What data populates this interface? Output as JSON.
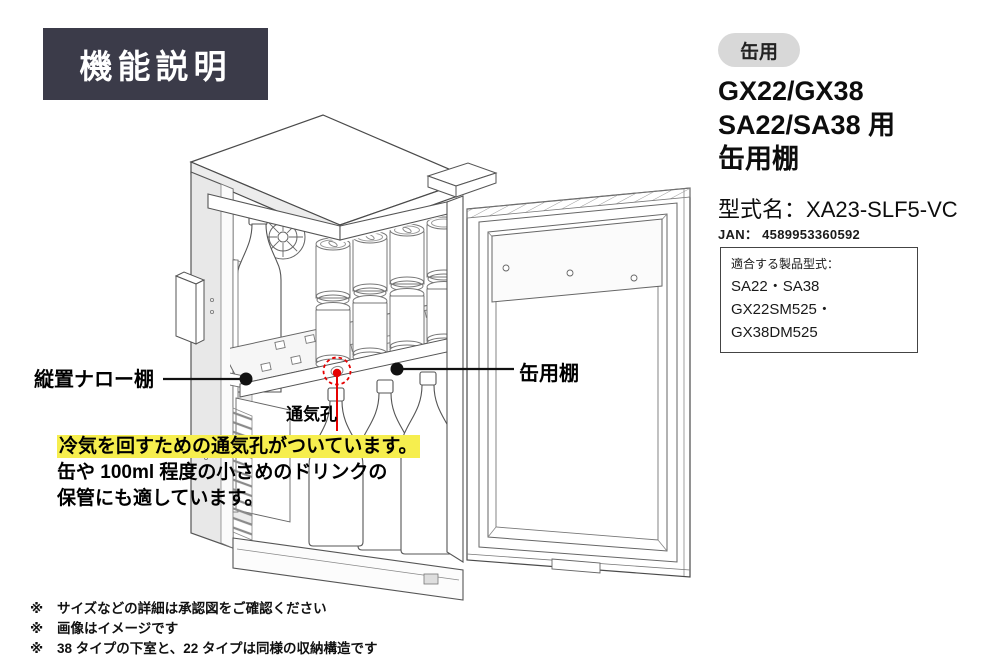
{
  "colors": {
    "title_bg": "#3b3b49",
    "pill_bg": "#d8d8d8",
    "highlight": "#f6ee4e",
    "red": "#e60000",
    "ink": "#1a1a1a"
  },
  "title_badge": "機能説明",
  "product": {
    "category_pill": "缶用",
    "title_lines": [
      "GX22/GX38",
      "SA22/SA38 用",
      "缶用棚"
    ],
    "model_label": "型式名：",
    "model_value": "XA23-SLF5-VC",
    "jan_label": "JAN：",
    "jan_value": "4589953360592",
    "compatible": {
      "title": "適合する製品型式：",
      "lines": [
        "SA22・SA38",
        "GX22SM525・GX38DM525"
      ]
    }
  },
  "callouts": {
    "narrow_shelf": "縦置ナロー棚",
    "can_shelf": "缶用棚",
    "vent_hole": "通気孔"
  },
  "description": {
    "highlighted": "冷気を回すための通気孔がついています。",
    "line2": "缶や 100ml 程度の小さめのドリンクの",
    "line3": "保管にも適しています。"
  },
  "notes": [
    {
      "marker": "※",
      "text": "サイズなどの詳細は承認図をご確認ください"
    },
    {
      "marker": "※",
      "text": "画像はイメージです"
    },
    {
      "marker": "※",
      "text": "38 タイプの下室と、22 タイプは同様の収納構造です"
    }
  ]
}
